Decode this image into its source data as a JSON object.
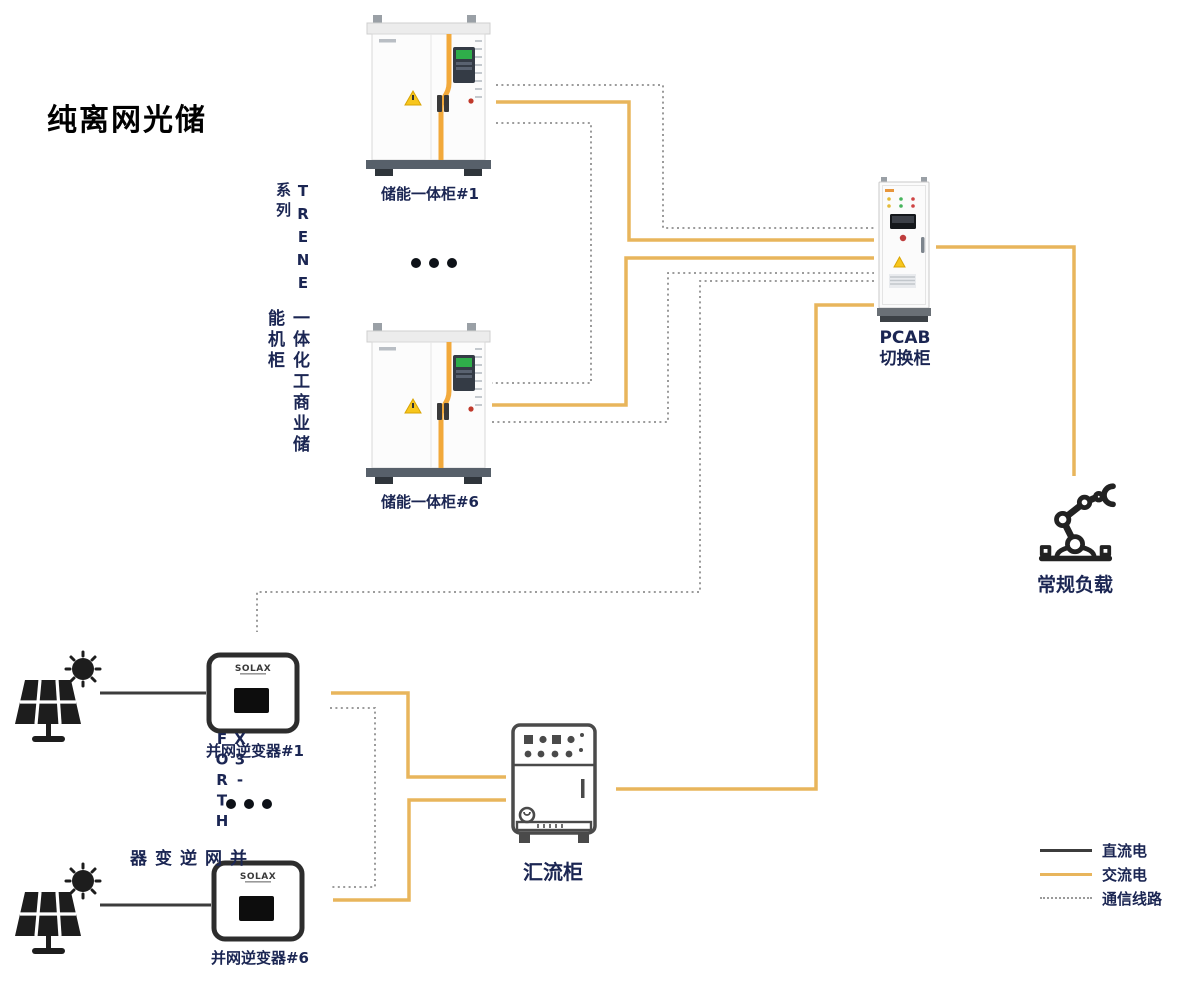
{
  "title": "纯离网光储",
  "colors": {
    "ac_line": "#E8B55C",
    "dc_line": "#3C3C3C",
    "comm_line": "#8F8F8F",
    "label": "#1B2653"
  },
  "storage_system": {
    "series_en": "TRENE 系列",
    "series_cn": "一体化工商业储能机柜",
    "cabinets": [
      {
        "label": "储能一体柜#1"
      },
      {
        "label": "储能一体柜#6"
      }
    ],
    "ellipsis": "•••"
  },
  "pv_system": {
    "series_en": "X3-FORTH",
    "series_cn": "并网逆变器",
    "inverters": [
      {
        "label": "并网逆变器#1",
        "logo": "SOLAX"
      },
      {
        "label": "并网逆变器#6",
        "logo": "SOLAX"
      }
    ],
    "ellipsis": "•••"
  },
  "pcab": {
    "label_line1": "PCAB",
    "label_line2": "切换柜"
  },
  "load": {
    "label": "常规负载"
  },
  "combiner": {
    "label": "汇流柜"
  },
  "legend": [
    {
      "type": "dc",
      "label": "直流电"
    },
    {
      "type": "ac",
      "label": "交流电"
    },
    {
      "type": "comm",
      "label": "通信线路"
    }
  ],
  "connections": [
    {
      "from": "光伏板#1",
      "to": "并网逆变器#1",
      "type": "直流电"
    },
    {
      "from": "光伏板#6",
      "to": "并网逆变器#6",
      "type": "直流电"
    },
    {
      "from": "储能一体柜#1",
      "to": "PCAB切换柜",
      "type": "交流电"
    },
    {
      "from": "储能一体柜#6",
      "to": "PCAB切换柜",
      "type": "交流电"
    },
    {
      "from": "并网逆变器#1",
      "to": "汇流柜",
      "type": "交流电"
    },
    {
      "from": "并网逆变器#6",
      "to": "汇流柜",
      "type": "交流电"
    },
    {
      "from": "汇流柜",
      "to": "PCAB切换柜",
      "type": "交流电"
    },
    {
      "from": "PCAB切换柜",
      "to": "常规负载",
      "type": "交流电"
    },
    {
      "from": "储能一体柜#1",
      "to": "PCAB切换柜",
      "type": "通信线路"
    },
    {
      "from": "储能一体柜#1",
      "to": "储能一体柜#6",
      "type": "通信线路"
    },
    {
      "from": "储能一体柜#6",
      "to": "PCAB切换柜",
      "type": "通信线路"
    },
    {
      "from": "并网逆变器#1",
      "to": "并网逆变器#6",
      "type": "通信线路"
    },
    {
      "from": "并网逆变器#1",
      "to": "PCAB切换柜",
      "type": "通信线路"
    }
  ]
}
